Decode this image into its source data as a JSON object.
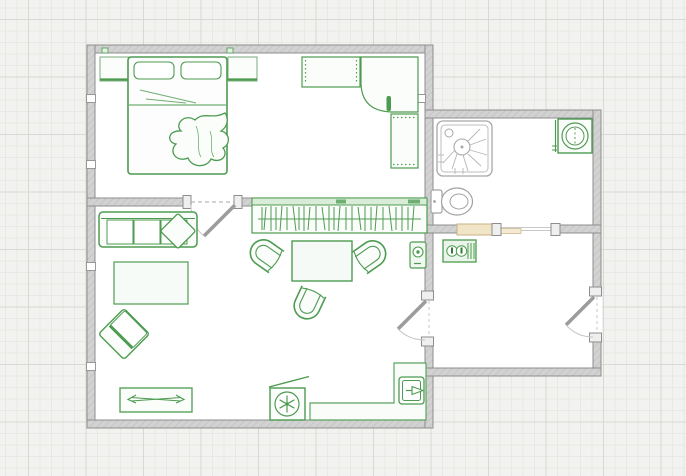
{
  "canvas": {
    "kind": "floor-plan",
    "grid": "graph-paper",
    "width_px": 686,
    "height_px": 476
  },
  "palette": {
    "furniture_green": "#4d9b51",
    "furniture_fill": "#fbfdfb",
    "fixture_gray": "#a2a2a2",
    "wall_fill": "#d2d2d2",
    "wall_edge": "#8e8e8e",
    "radiator_tan": "#f0e5c6",
    "radiator_edge": "#c8b184",
    "floor": "#ffffff",
    "grid_minor": "#e8e8e5",
    "grid_major": "#d8d8d4",
    "background": "#f2f2f0"
  },
  "rooms": [
    {
      "name": "Bedroom",
      "items": [
        "double-bed",
        "pillow",
        "pillow",
        "crumpled-duvet",
        "nightstand-left",
        "nightstand-right",
        "dresser",
        "corner-desk",
        "desk-cabinet"
      ]
    },
    {
      "name": "Living room",
      "items": [
        "sofa",
        "throw-pillow",
        "rug",
        "armchair",
        "coffee-table",
        "tub-chair-left",
        "tub-chair-right",
        "tub-chair-bottom",
        "tv-stand",
        "open-wardrobe-rack",
        "portable-ac-unit",
        "kitchen-counter",
        "sink",
        "wall-intercom"
      ]
    },
    {
      "name": "Bathroom",
      "items": [
        "shower-cabin",
        "washing-machine",
        "toilet",
        "radiator"
      ]
    },
    {
      "name": "Hallway",
      "items": [
        "electrical-panel"
      ]
    }
  ],
  "openings": {
    "doors": [
      {
        "between": "bedroom and living room",
        "swing": "into living room"
      },
      {
        "between": "living room and hallway",
        "swing": "into living room"
      },
      {
        "between": "hallway and exterior",
        "swing": "into hallway"
      }
    ],
    "passages": [
      {
        "between": "bathroom and hallway",
        "type": "open doorway with threshold"
      }
    ],
    "wall_outlet_count": 5
  }
}
